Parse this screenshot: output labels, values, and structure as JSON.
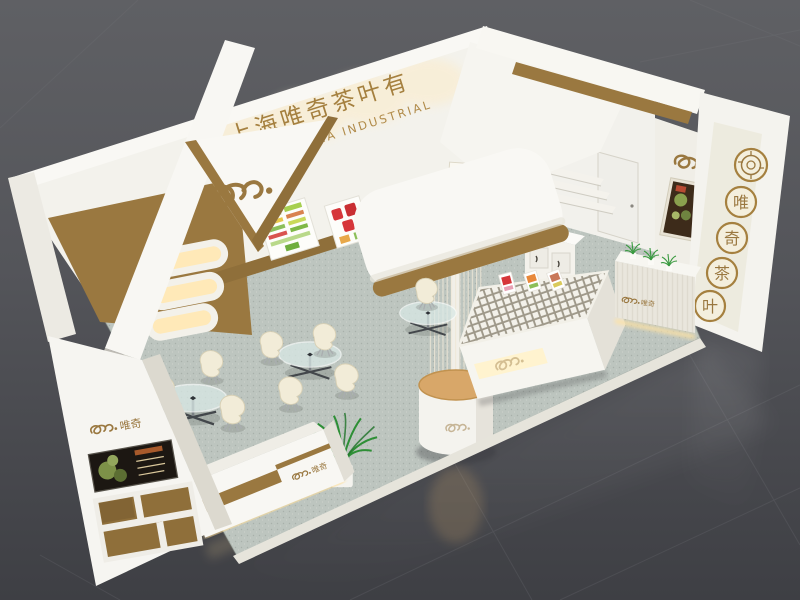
{
  "scene": {
    "subject": "3D rendering of a tea brand exhibition booth",
    "view": "aerial perspective on dark exhibition hall floor"
  },
  "branding": {
    "logo_script": "wa.",
    "logo_cn": "唯奇",
    "logo_full": "wa.唯奇",
    "company_sign_cn": "上海唯奇茶叶有",
    "company_sign_en": "SHANGHAI TEA INDUSTRIAL",
    "scroll_chars": [
      "唯",
      "奇"
    ],
    "medallions": [
      "唯",
      "奇",
      "茶",
      "叶"
    ]
  },
  "colors": {
    "background": "#55565a",
    "wall_white": "#f5f4ef",
    "accent_brown": "#9a7840",
    "carpet": "#bdc5bf",
    "warm_glow": "#ffe9b8",
    "tan_top": "#d8a769",
    "plant_green": "#2f9238",
    "poster_red": "#d6363a"
  }
}
